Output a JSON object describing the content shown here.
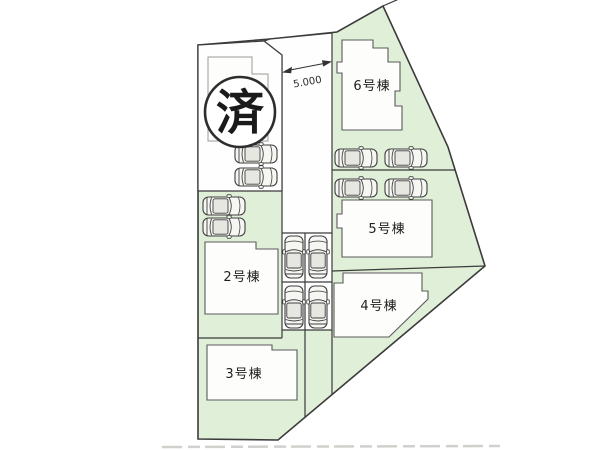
{
  "site_plan": {
    "sold_badge": "済",
    "dimension_label": "5.000",
    "buildings": {
      "b2": "2号棟",
      "b3": "3号棟",
      "b4": "4号棟",
      "b5": "5号棟",
      "b6": "6号棟"
    },
    "parking": {
      "icon": "car-top-view-icon",
      "groups": [
        {
          "area": "lot-1",
          "count": 2,
          "orientation": "horizontal"
        },
        {
          "area": "lot-2",
          "count": 2,
          "orientation": "horizontal"
        },
        {
          "area": "central-driveway",
          "count": 4,
          "orientation": "vertical"
        },
        {
          "area": "lot-5-and-6",
          "count": 4,
          "orientation": "horizontal"
        }
      ]
    },
    "colors": {
      "lot_green": "#e0efd8",
      "outline": "#3b3b3b",
      "background": "#ffffff"
    }
  }
}
